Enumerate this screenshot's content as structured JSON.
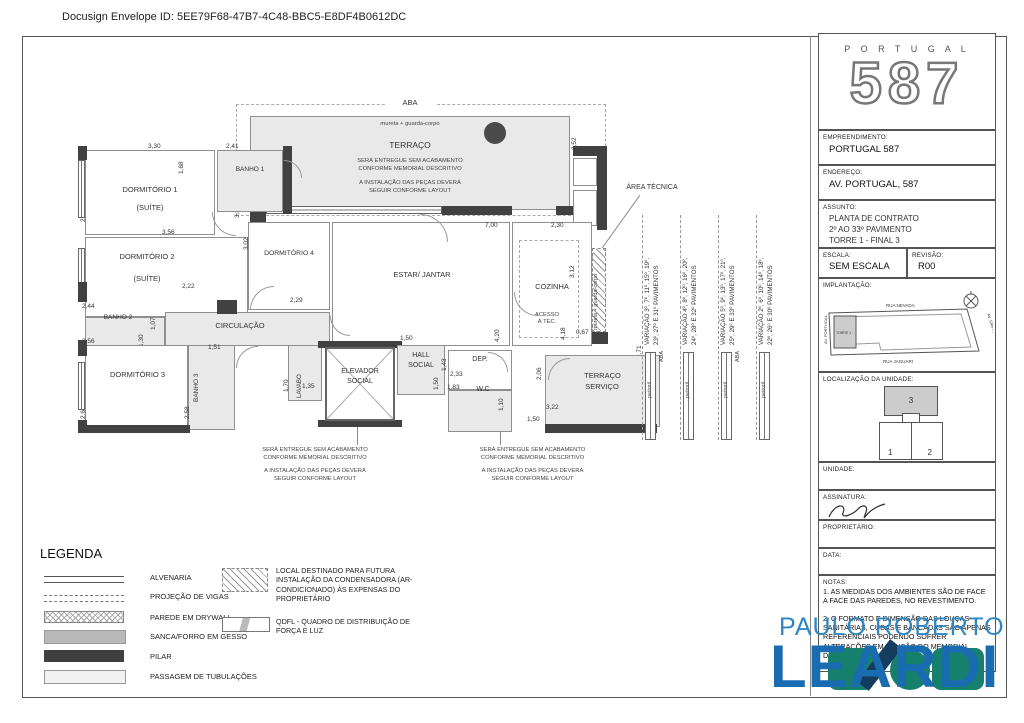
{
  "docusign_header": "Docusign Envelope ID: 5EE79F68-47B7-4C48-BBC5-E8DF4B0612DC",
  "plan": {
    "labels": {
      "aba": "ABA",
      "mureta": "mureta + guarda-corpo",
      "terraco": "TERRAÇO",
      "dorm1": "DORMITÓRIO 1",
      "suite": "(SUÍTE)",
      "banho1": "BANHO 1",
      "dorm2": "DORMITÓRIO 2",
      "banho2": "BANHO 2",
      "circulacao": "CIRCULAÇÃO",
      "dorm3": "DORMITÓRIO 3",
      "banho3": "BANHO 3",
      "dorm4": "DORMITÓRIO 4",
      "estar": "ESTAR/ JANTAR",
      "cozinha": "COZINHA",
      "area_tecnica": "ÁREA TÉCNICA",
      "acesso1": "ACESSO",
      "acesso2": "Á TEC.",
      "lavabo": "LAVABO",
      "elevador1": "ELEVADOR",
      "elevador2": "SOCIAL",
      "hall1": "HALL",
      "hall2": "SOCIAL",
      "dep": "DEP.",
      "wc": "W.C",
      "tserv1": "TERRAÇO",
      "tserv2": "SERVIÇO",
      "peitoril": "peitoril",
      "aba_v": "ABA"
    },
    "notes": {
      "n1": "SERÁ ENTREGUE SEM ACABAMENTO",
      "n2": "CONFORME MEMORIAL DESCRITIVO",
      "n3": "A INSTALAÇÃO DAS PEÇAS DEVERÁ",
      "n4": "SEGUIR CONFORME LAYOUT"
    },
    "variacoes": [
      {
        "l1": "VARIAÇÃO 3º, 7º, 11º, 15º, 19º,",
        "l2": "23º, 27º E 31º PAVIMENTOS"
      },
      {
        "l1": "VARIAÇÃO 4º, 8º, 12º, 16º, 20º,",
        "l2": "24º, 28º E 32º PAVIMENTOS"
      },
      {
        "l1": "VARIAÇÃO 5º, 9º, 13º, 17º, 21º,",
        "l2": "25º, 29º E 33º PAVIMENTOS"
      },
      {
        "l1": "VARIAÇÃO 2º, 6º, 10º, 14º, 18º,",
        "l2": "22º, 26º E 30º PAVIMENTOS"
      }
    ],
    "dims": {
      "terraco_w": "11,33",
      "terraco_h": "3,52",
      "wall_l": "3,88",
      "dorm1_w": "3,30",
      "dorm1_h": "2,70",
      "banho1_w": "2,41",
      "banho1_h": "1,68",
      "dorm2_w": "3,56",
      "dorm2_h": "2,55",
      "pass1": "2,22",
      "banho2_w": "2,44",
      "pass2": "1,07",
      "banho2_h": "1,30",
      "dorm3_w": "3,56",
      "dorm3_h": "2,60",
      "banho3_w": "1,51",
      "banho3_h": "2,58",
      "dorm4_h": "3,02",
      "dorm4_w": "2,29",
      "estar_w": "7,00",
      "estar_h": "4,20",
      "coz_w": "2,30",
      "coz_h": "3,12",
      "coz_h2": "4,18",
      "coz_p": "0,67",
      "right_h": "2,71",
      "lavabo_h": "1,70",
      "lavabo_w": "1,35",
      "hall_w": "1,50",
      "hall_h": "1,50",
      "dep_h": "1,43",
      "dep_w": "2,33",
      "wc_w": "1,83",
      "wc_h": "1,10",
      "tserv_w": "3,22",
      "tserv_p": "1,50",
      "tserv_h": "2,06"
    }
  },
  "legend": {
    "title": "LEGENDA",
    "items": [
      "ALVENARIA",
      "PROJEÇÃO DE VIGAS",
      "PAREDE EM DRYWALL",
      "SANCA/FORRO EM GESSO",
      "PILAR",
      "PASSAGEM DE TUBULAÇÕES"
    ],
    "extra1": "LOCAL DESTINADO PARA FUTURA INSTALAÇÃO DA CONDENSADORA (AR-CONDICIONADO) ÀS EXPENSAS DO PROPRIETÁRIO",
    "extra2": "QDFL - QUADRO DE DISTRIBUIÇÃO DE FORÇA E LUZ"
  },
  "title_block": {
    "brand": "P O R T U G A L",
    "brand_number": "587",
    "empreendimento_label": "EMPREENDIMENTO:",
    "empreendimento": "PORTUGAL 587",
    "endereco_label": "ENDEREÇO:",
    "endereco": "AV. PORTUGAL, 587",
    "assunto_label": "ASSUNTO:",
    "assunto1": "PLANTA DE CONTRATO",
    "assunto2": "2º AO 33º PAVIMENTO",
    "assunto3": "TORRE 1 - FINAL 3",
    "escala_label": "ESCALA:",
    "escala": "SEM ESCALA",
    "revisao_label": "REVISÃO:",
    "revisao": "R00",
    "implantacao_label": "IMPLANTAÇÃO:",
    "site": {
      "street_top": "RUA NEVADA",
      "street_bottom": "RUA JAGUARI",
      "street_left": "AV. PORTUGAL",
      "street_right": "AV. SANTO AMARO",
      "tower": "TORRE 1"
    },
    "localizacao_label": "LOCALIZAÇÃO DA UNIDADE:",
    "unit1": "1",
    "unit2": "2",
    "unit3": "3",
    "unidade_label": "UNIDADE:",
    "assinatura_label": "ASSINATURA:",
    "proprietario_label": "PROPRIETÁRIO:",
    "data_label": "DATA:",
    "notas_label": "NOTAS:",
    "nota1": "1. AS MEDIDAS DOS AMBIENTES SÃO DE FACE A FACE DAS PAREDES, NO REVESTIMENTO.",
    "nota2": "2. O FORMATO E DIMENSÃO DAS LOUÇAS SANITÁRIAS, CUBAS E BANCADAS SÃO APENAS REFERENCIAIS PODENDO SOFRER ALTERAÇÕES EM FUNÇÃO DO MEMORIAL DESCRITIVO."
  },
  "watermark": {
    "line1": "PAULO ROBERTO",
    "line2": "LEARDI",
    "blue": "#2e86c4",
    "dark_blue": "#1a6cb0",
    "teal": "#17806d"
  }
}
